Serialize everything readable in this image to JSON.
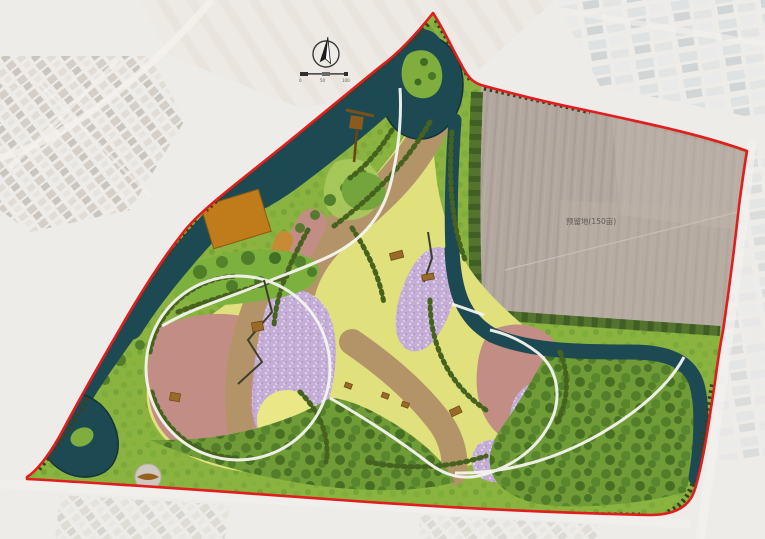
{
  "plan": {
    "field_label": "预留地(150亩)",
    "scale_ticks": [
      "0",
      "50",
      "100"
    ],
    "palette": {
      "boundary_red": "#e01e1e",
      "water": "#1d4a52",
      "lawn_yellow": "#e0e07c",
      "band_tan": "#b29468",
      "band_pink": "#c28d85",
      "band_purple": "#c4aed6",
      "band_orange": "#c78a35",
      "greenery": "#8ab43f",
      "forest": "#4e7a28",
      "deck_brown": "#c07c1a",
      "reserved_field_gray": "#b3a89f",
      "path_white": "#f6f5ef",
      "background": "#e9e7e3"
    }
  }
}
